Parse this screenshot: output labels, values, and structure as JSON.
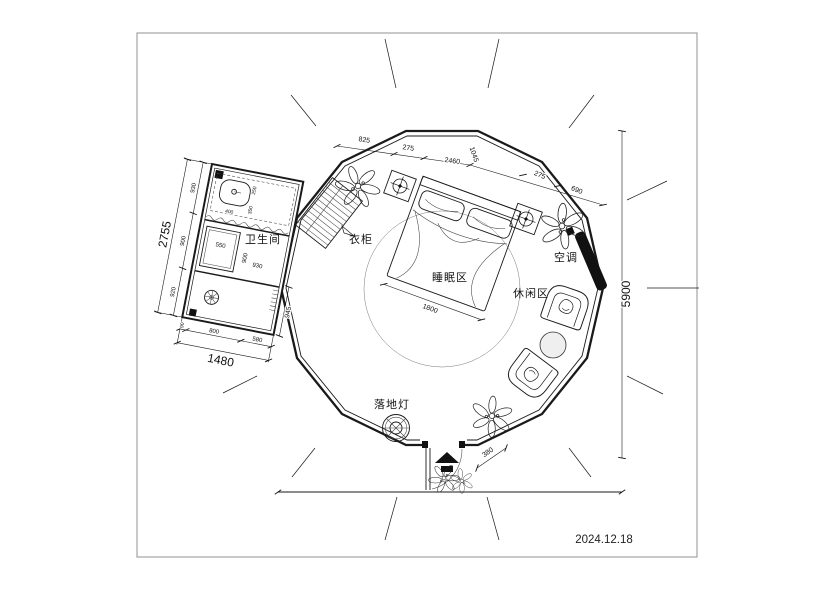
{
  "title_block": {
    "date": "2024.12.18"
  },
  "room_labels": {
    "bathroom": "卫生间",
    "wardrobe": "衣柜",
    "sleeping": "睡眠区",
    "leisure": "休闲区",
    "ac": "空调",
    "floor_lamp": "落地灯"
  },
  "dimensions": {
    "bathroom_left_total": "2755",
    "bathroom_left_segments": [
      "930",
      "900",
      "920"
    ],
    "bathroom_bottom_segments": [
      "90",
      "800",
      "580"
    ],
    "bathroom_bottom_total": "1480",
    "bathroom_right": "945",
    "bathroom_inner": {
      "sink_width": "400",
      "v1": "250",
      "v2": "350",
      "shower_tray": "550",
      "inner_h": "900",
      "inner_w": "930"
    },
    "top_chain": [
      "825",
      "275",
      "2460",
      "1045",
      "275",
      "690"
    ],
    "height_total": "5900",
    "bed_width": "1800",
    "entry_side": "380"
  }
}
